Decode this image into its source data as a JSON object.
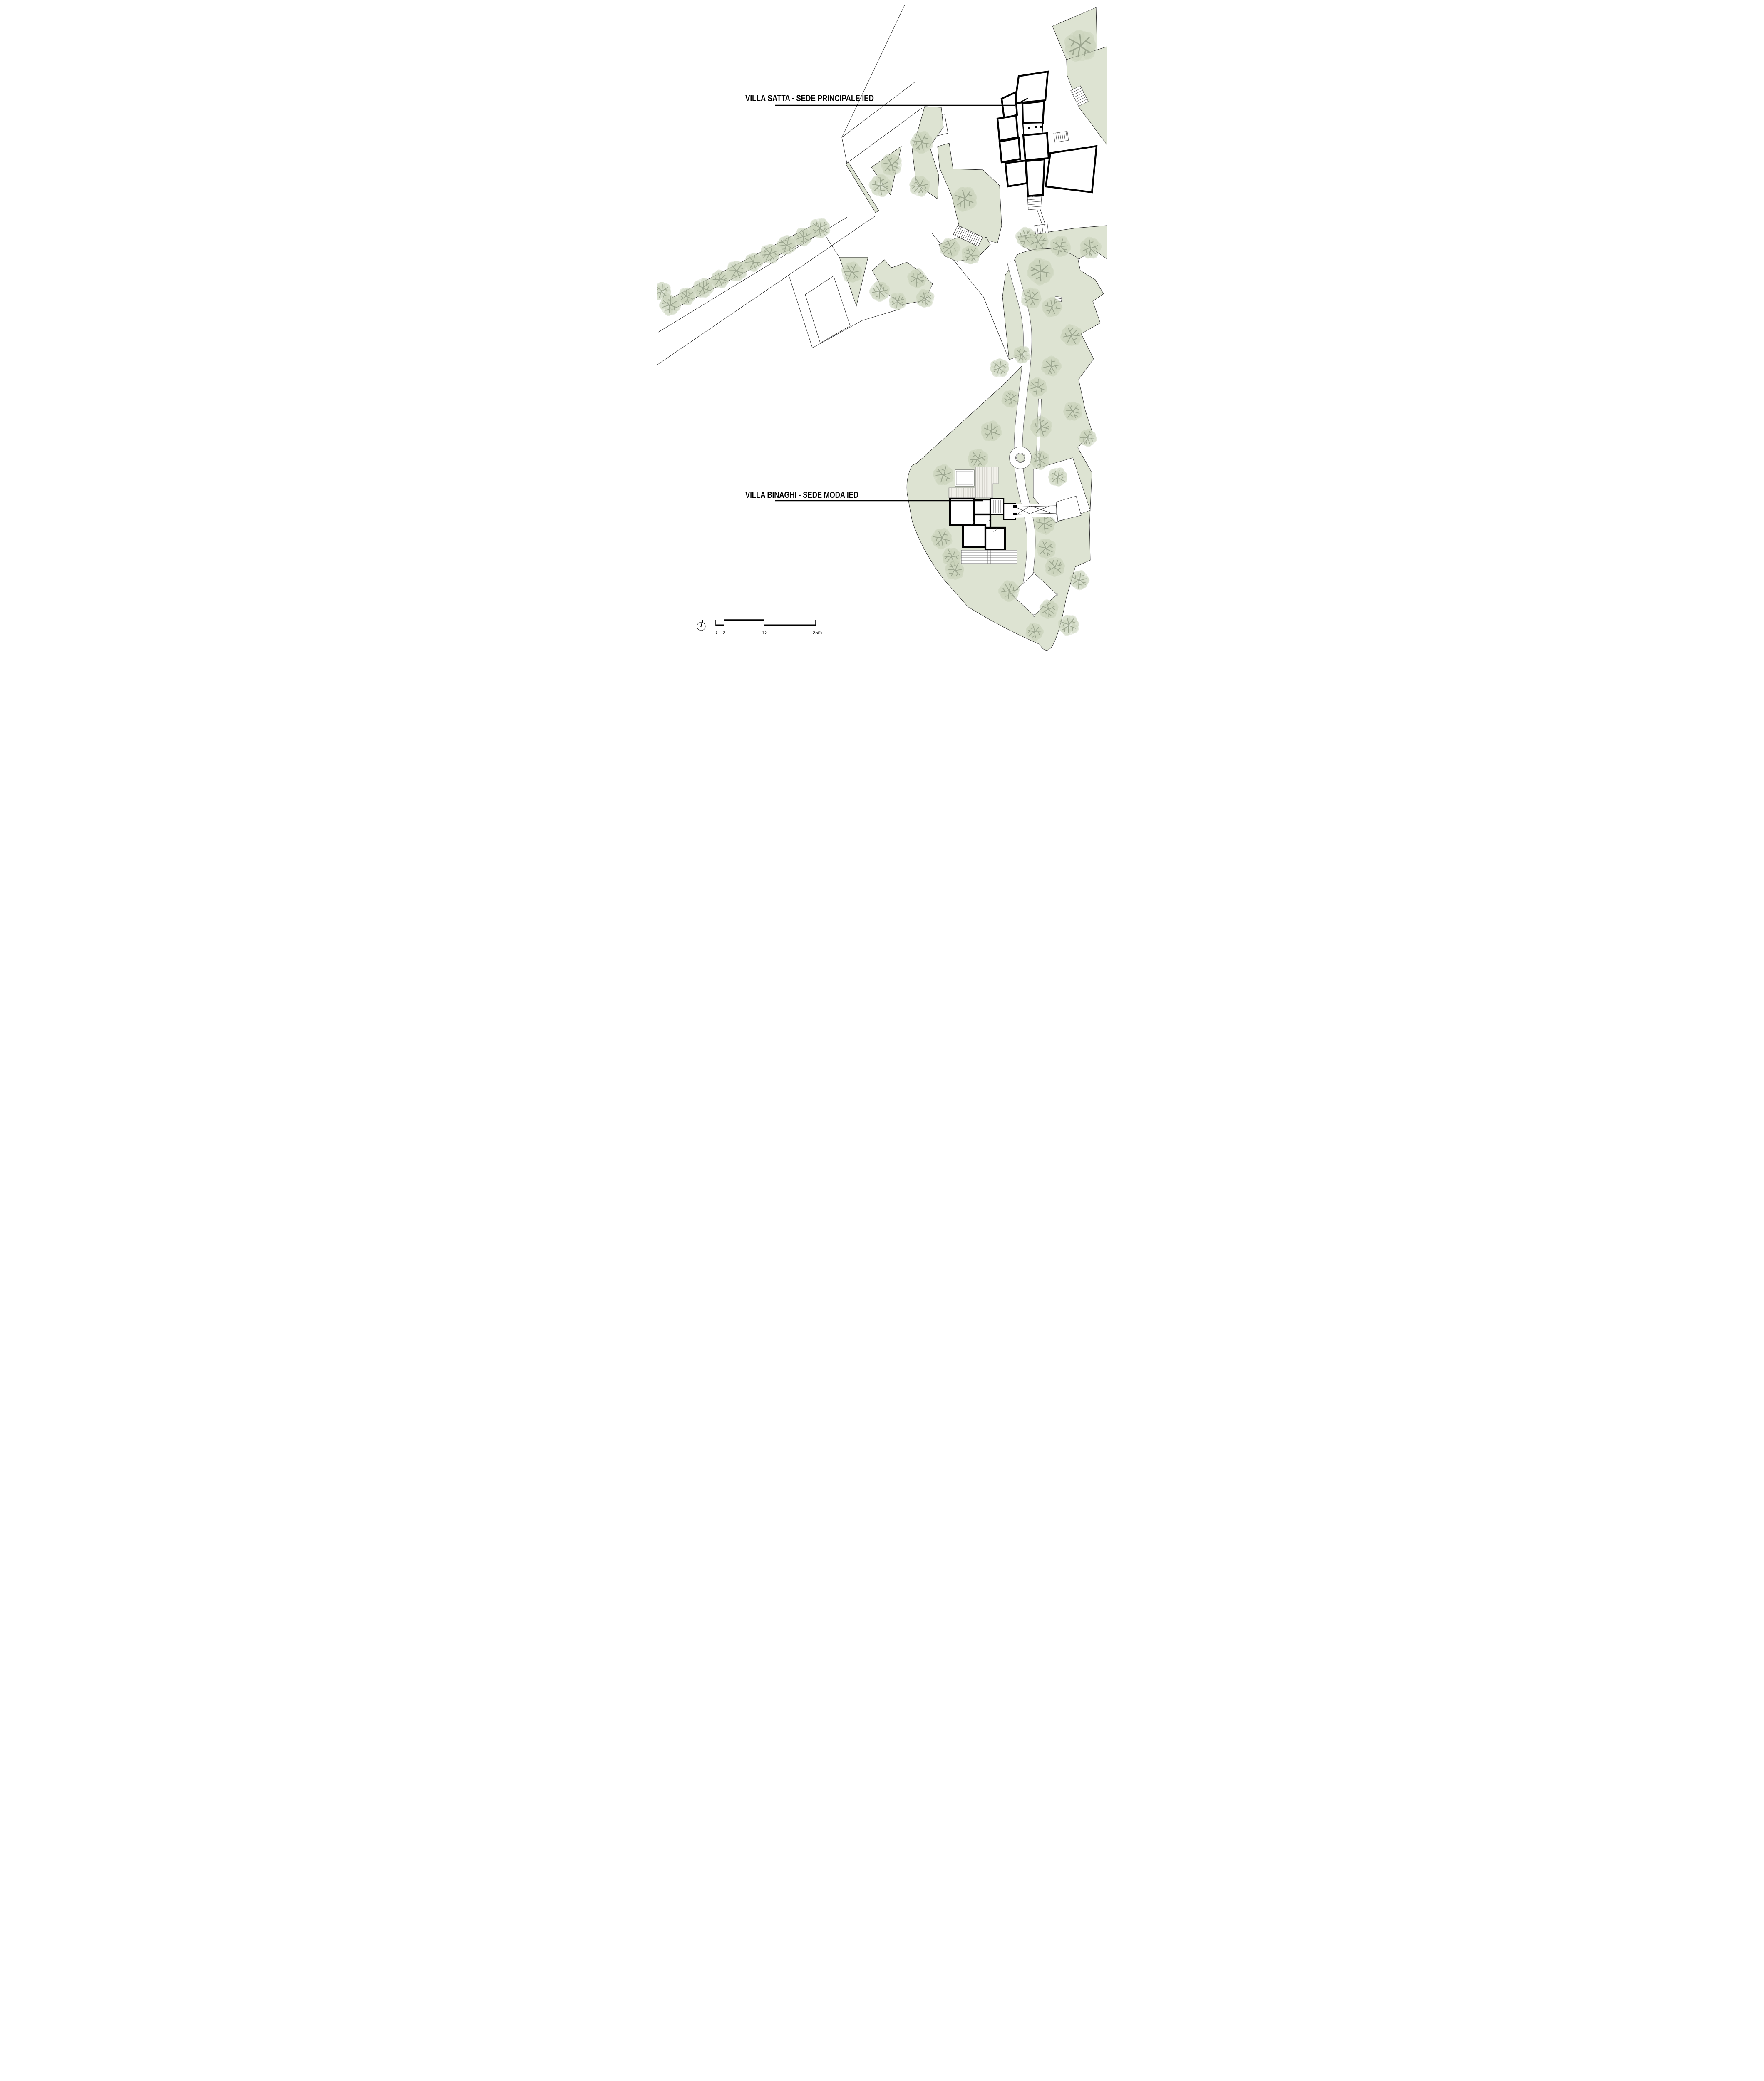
{
  "labels": {
    "villa_satta": "VILLA SATTA - SEDE PRINCIPALE IED",
    "villa_binaghi": "VILLA BINAGHI - SEDE MODA IED"
  },
  "scale_bar": {
    "tick_0": "0",
    "tick_2": "2",
    "tick_12": "12",
    "tick_25": "25m"
  },
  "icons": [
    {
      "name": "north-indicator-icon",
      "shape": "circle-with-needle"
    }
  ],
  "colors": {
    "paper": "#ffffff",
    "green_area": "#dde3d2",
    "tree_crown": "#c7d1b8",
    "tree_crown_light": "#d8dfcb",
    "tree_branch": "#97a18b",
    "wall": "#000000",
    "boundary_line": "#1c1c1c",
    "deck_stripe": "#c9c8c0",
    "path_edge": "#666666"
  },
  "vegetation": {
    "tree_count": 56,
    "trees": [
      [
        10,
        700,
        24
      ],
      [
        30,
        733,
        26
      ],
      [
        70,
        712,
        22
      ],
      [
        110,
        692,
        25
      ],
      [
        150,
        671,
        23
      ],
      [
        190,
        651,
        26
      ],
      [
        230,
        630,
        23
      ],
      [
        270,
        610,
        25
      ],
      [
        310,
        589,
        24
      ],
      [
        350,
        569,
        23
      ],
      [
        390,
        548,
        26
      ],
      [
        536,
        446,
        28
      ],
      [
        562,
        396,
        27
      ],
      [
        635,
        342,
        28
      ],
      [
        630,
        447,
        26
      ],
      [
        467,
        654,
        26
      ],
      [
        534,
        700,
        25
      ],
      [
        577,
        724,
        22
      ],
      [
        624,
        669,
        24
      ],
      [
        643,
        717,
        23
      ],
      [
        738,
        478,
        31
      ],
      [
        703,
        596,
        25
      ],
      [
        753,
        612,
        24
      ],
      [
        885,
        570,
        25
      ],
      [
        915,
        580,
        26
      ],
      [
        968,
        592,
        26
      ],
      [
        1040,
        596,
        27
      ],
      [
        1016,
        110,
        40
      ],
      [
        920,
        652,
        33
      ],
      [
        898,
        716,
        26
      ],
      [
        948,
        738,
        25
      ],
      [
        995,
        806,
        27
      ],
      [
        876,
        852,
        22
      ],
      [
        946,
        880,
        25
      ],
      [
        822,
        884,
        24
      ],
      [
        913,
        930,
        24
      ],
      [
        848,
        958,
        22
      ],
      [
        802,
        1036,
        26
      ],
      [
        922,
        1026,
        27
      ],
      [
        998,
        988,
        24
      ],
      [
        1034,
        1052,
        22
      ],
      [
        770,
        1103,
        26
      ],
      [
        687,
        1141,
        26
      ],
      [
        919,
        1105,
        24
      ],
      [
        962,
        1146,
        24
      ],
      [
        930,
        1258,
        27
      ],
      [
        934,
        1318,
        25
      ],
      [
        683,
        1294,
        26
      ],
      [
        707,
        1338,
        24
      ],
      [
        714,
        1370,
        24
      ],
      [
        845,
        1420,
        26
      ],
      [
        955,
        1362,
        25
      ],
      [
        1014,
        1394,
        24
      ],
      [
        940,
        1464,
        24
      ],
      [
        988,
        1502,
        26
      ],
      [
        906,
        1518,
        22
      ]
    ]
  }
}
